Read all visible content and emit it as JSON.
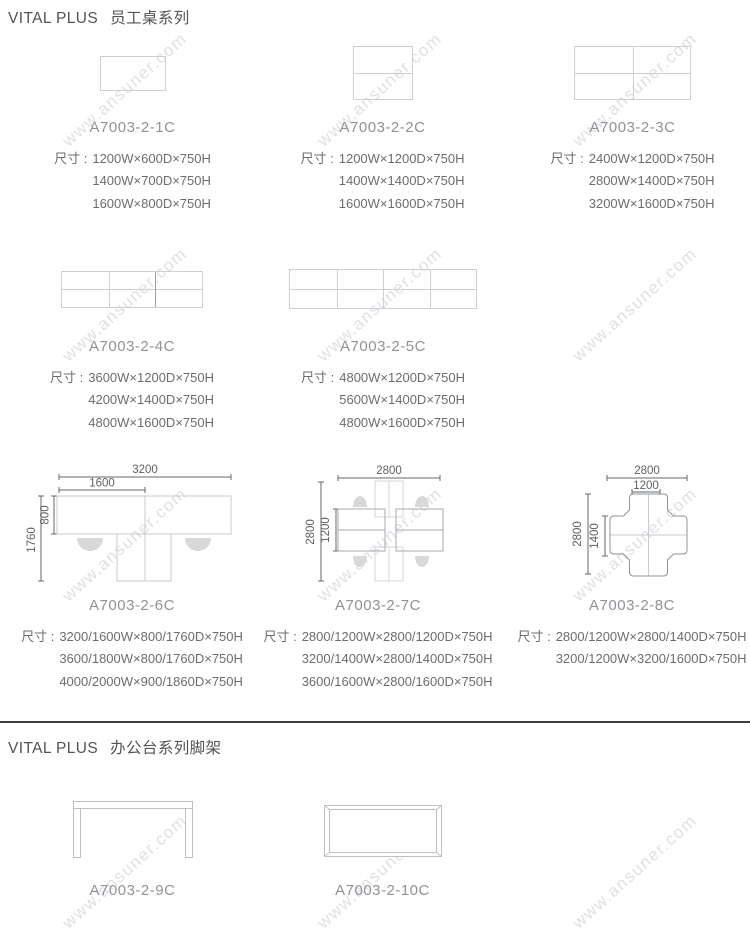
{
  "watermark": {
    "text": "www.ansuner.com"
  },
  "sections": [
    {
      "brand": "VITAL PLUS",
      "series": "员工桌系列"
    },
    {
      "brand": "VITAL PLUS",
      "series": "办公台系列脚架"
    }
  ],
  "size_prefix": "尺寸 :",
  "colors": {
    "divider": "#3c3c3c",
    "outline": "#c7cbcf",
    "dim_line": "#63676b",
    "dim_text": "#6a6d70",
    "code_text": "#8f9296"
  },
  "products": [
    {
      "id": "A7003-2-1C",
      "sizes": [
        "1200W×600D×750H",
        "1400W×700D×750H",
        "1600W×800D×750H"
      ]
    },
    {
      "id": "A7003-2-2C",
      "sizes": [
        "1200W×1200D×750H",
        "1400W×1400D×750H",
        "1600W×1600D×750H"
      ]
    },
    {
      "id": "A7003-2-3C",
      "sizes": [
        "2400W×1200D×750H",
        "2800W×1400D×750H",
        "3200W×1600D×750H"
      ]
    },
    {
      "id": "A7003-2-4C",
      "sizes": [
        "3600W×1200D×750H",
        "4200W×1400D×750H",
        "4800W×1600D×750H"
      ]
    },
    {
      "id": "A7003-2-5C",
      "sizes": [
        "4800W×1200D×750H",
        "5600W×1400D×750H",
        "4800W×1600D×750H"
      ]
    },
    {
      "id": "A7003-2-6C",
      "sizes": [
        "3200/1600W×800/1760D×750H",
        "3600/1800W×800/1760D×750H",
        "4000/2000W×900/1860D×750H"
      ],
      "annotations": {
        "total_w": "3200",
        "half_w": "1600",
        "bar_d": "800",
        "total_d": "1760"
      }
    },
    {
      "id": "A7003-2-7C",
      "sizes": [
        "2800/1200W×2800/1200D×750H",
        "3200/1400W×2800/1400D×750H",
        "3600/1600W×2800/1600D×750H"
      ],
      "annotations": {
        "total_w": "2800",
        "total_d": "2800",
        "inner_d": "1200"
      }
    },
    {
      "id": "A7003-2-8C",
      "sizes": [
        "2800/1200W×2800/1400D×750H",
        "3200/1200W×3200/1600D×750H"
      ],
      "annotations": {
        "total_w": "2800",
        "inner_w": "1200",
        "total_d": "2800",
        "inner_d": "1400"
      }
    },
    {
      "id": "A7003-2-9C",
      "sizes": []
    },
    {
      "id": "A7003-2-10C",
      "sizes": []
    }
  ]
}
